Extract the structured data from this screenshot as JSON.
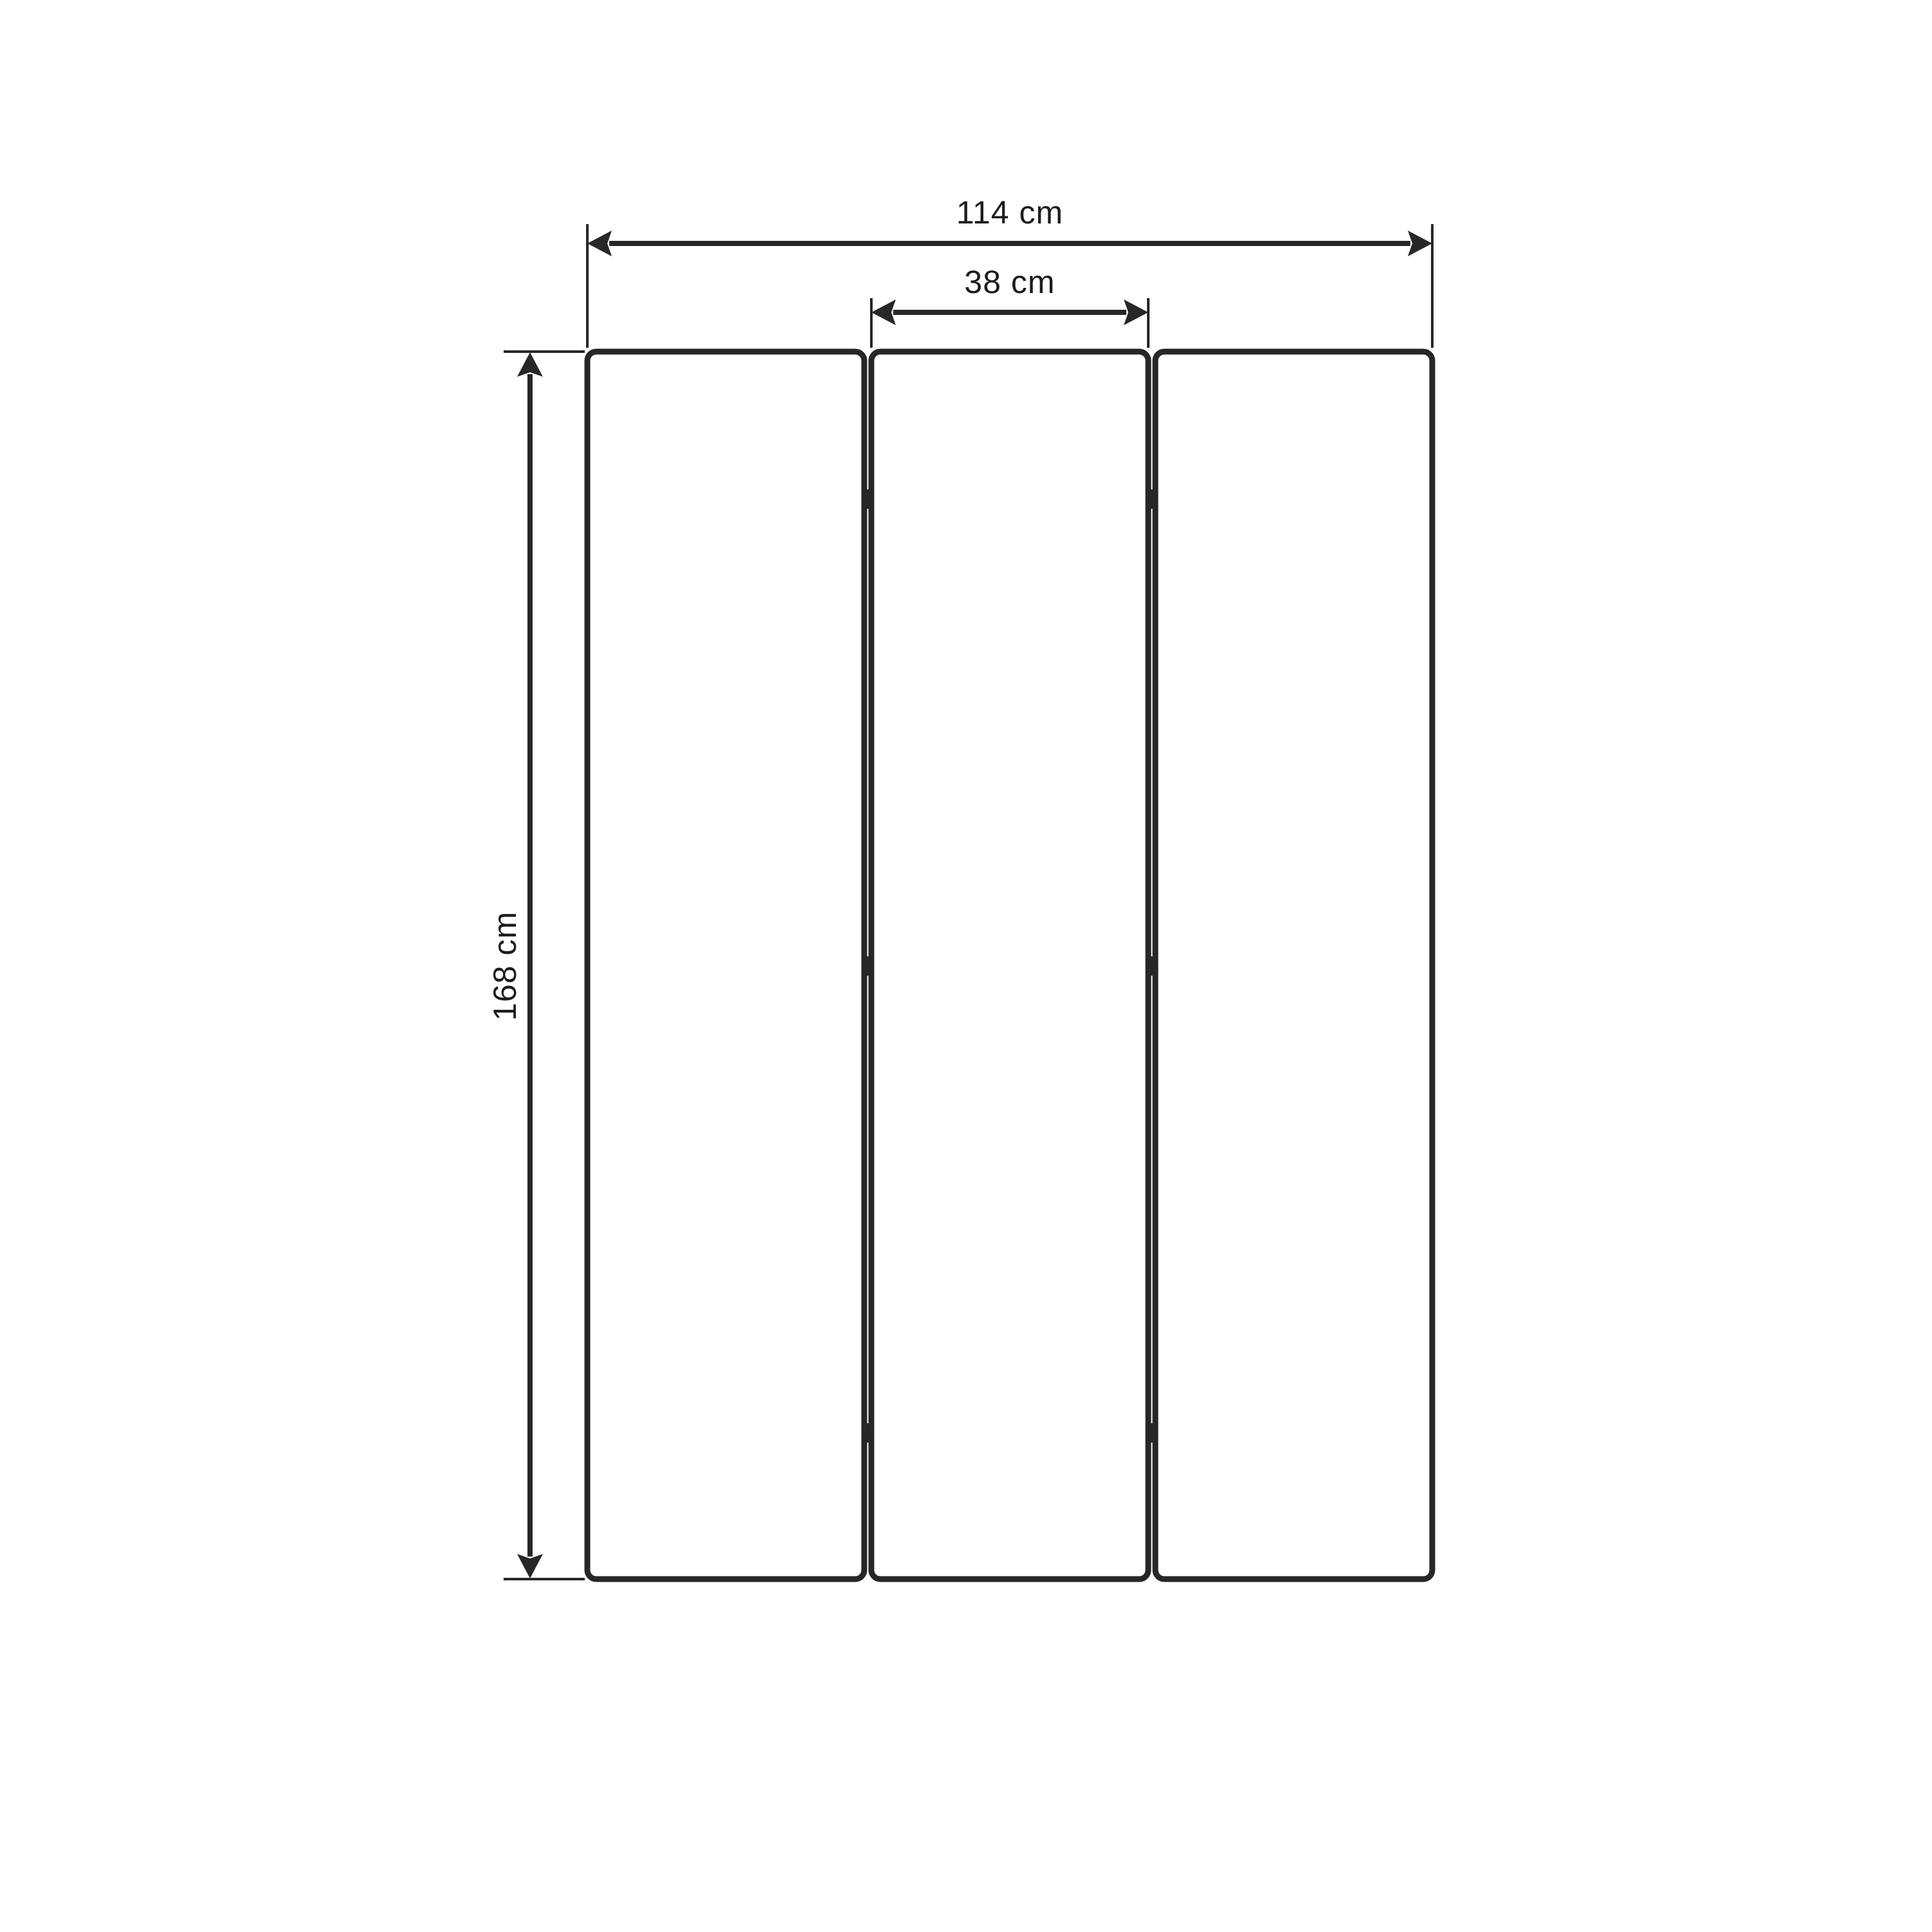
{
  "diagram": {
    "type": "furniture-dimension-drawing",
    "subject": "three-panel folding screen, front view",
    "panel_count": 3,
    "hinges_per_joint": 3,
    "dimensions": {
      "total_width": {
        "label": "114 cm"
      },
      "panel_width": {
        "label": "38 cm"
      },
      "height": {
        "label": "168 cm"
      }
    },
    "colors": {
      "line": "#272727",
      "text": "#1c1c1c",
      "background": "#ffffff"
    }
  }
}
